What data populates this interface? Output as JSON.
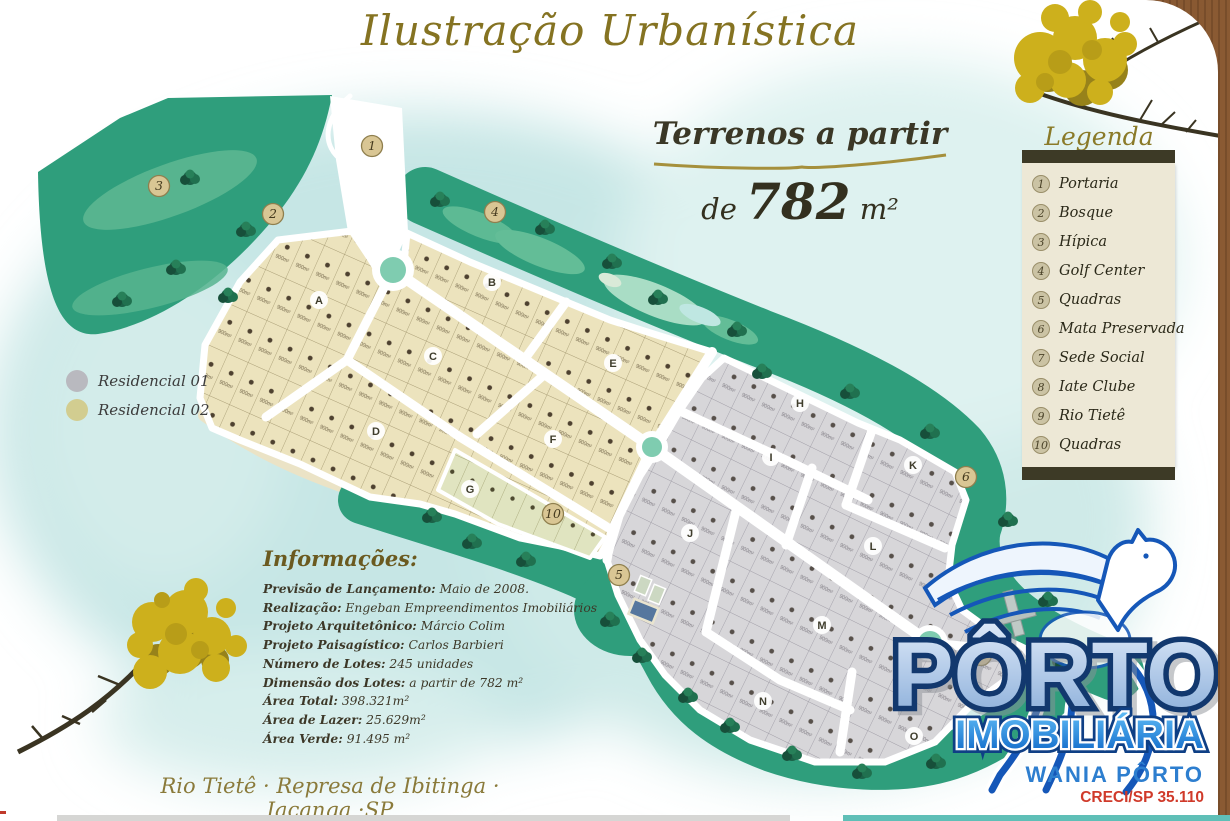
{
  "page": {
    "title": "Ilustração Urbanística"
  },
  "offer": {
    "line1": "Terrenos a partir",
    "line2_prefix": "de",
    "value": "782",
    "unit": "m²"
  },
  "legend": {
    "title": "Legenda",
    "items": [
      {
        "num": "1",
        "label": "Portaria"
      },
      {
        "num": "2",
        "label": "Bosque"
      },
      {
        "num": "3",
        "label": "Hípica"
      },
      {
        "num": "4",
        "label": "Golf Center"
      },
      {
        "num": "5",
        "label": "Quadras"
      },
      {
        "num": "6",
        "label": "Mata Preservada"
      },
      {
        "num": "7",
        "label": "Sede Social"
      },
      {
        "num": "8",
        "label": "Iate Clube"
      },
      {
        "num": "9",
        "label": "Rio Tietê"
      },
      {
        "num": "10",
        "label": "Quadras"
      }
    ]
  },
  "residencial": {
    "items": [
      {
        "label": "Residencial 01",
        "color": "#b9b9bf"
      },
      {
        "label": "Residencial 02",
        "color": "#d2cd90"
      }
    ]
  },
  "info": {
    "title": "Informações:",
    "lines": [
      {
        "label": "Previsão de Lançamento:",
        "value": " Maio de 2008."
      },
      {
        "label": "Realização:",
        "value": " Engeban Empreendimentos Imobiliários"
      },
      {
        "label": "Projeto Arquitetônico:",
        "value": " Márcio Colim"
      },
      {
        "label": "Projeto Paisagístico:",
        "value": " Carlos Barbieri"
      },
      {
        "label": "Número de Lotes:",
        "value": " 245 unidades"
      },
      {
        "label": "Dimensão dos Lotes:",
        "value": " a partir de 782 m²"
      },
      {
        "label": "Área Total:",
        "value": " 398.321m²"
      },
      {
        "label": "Área de Lazer:",
        "value": " 25.629m²"
      },
      {
        "label": "Área Verde:",
        "value": " 91.495 m²"
      }
    ]
  },
  "footer": {
    "location": "Rio Tietê · Represa de Ibitinga · Iacanga ·SP"
  },
  "logo": {
    "name": "PÔRTO",
    "line2": "IMOBILIÁRIA",
    "agent": "WANIA PÔRTO",
    "creci": "CRECI/SP 35.110"
  },
  "map": {
    "lot_area_sample": "900m²",
    "accent_green": "#2f9e7c",
    "roundabout_color": "#7fccb0",
    "blocks": [
      "A",
      "B",
      "C",
      "D",
      "E",
      "F",
      "G",
      "H",
      "I",
      "J",
      "K",
      "L",
      "M",
      "N",
      "O"
    ],
    "markers": [
      "1",
      "2",
      "3",
      "4",
      "5",
      "6",
      "7",
      "10"
    ]
  }
}
